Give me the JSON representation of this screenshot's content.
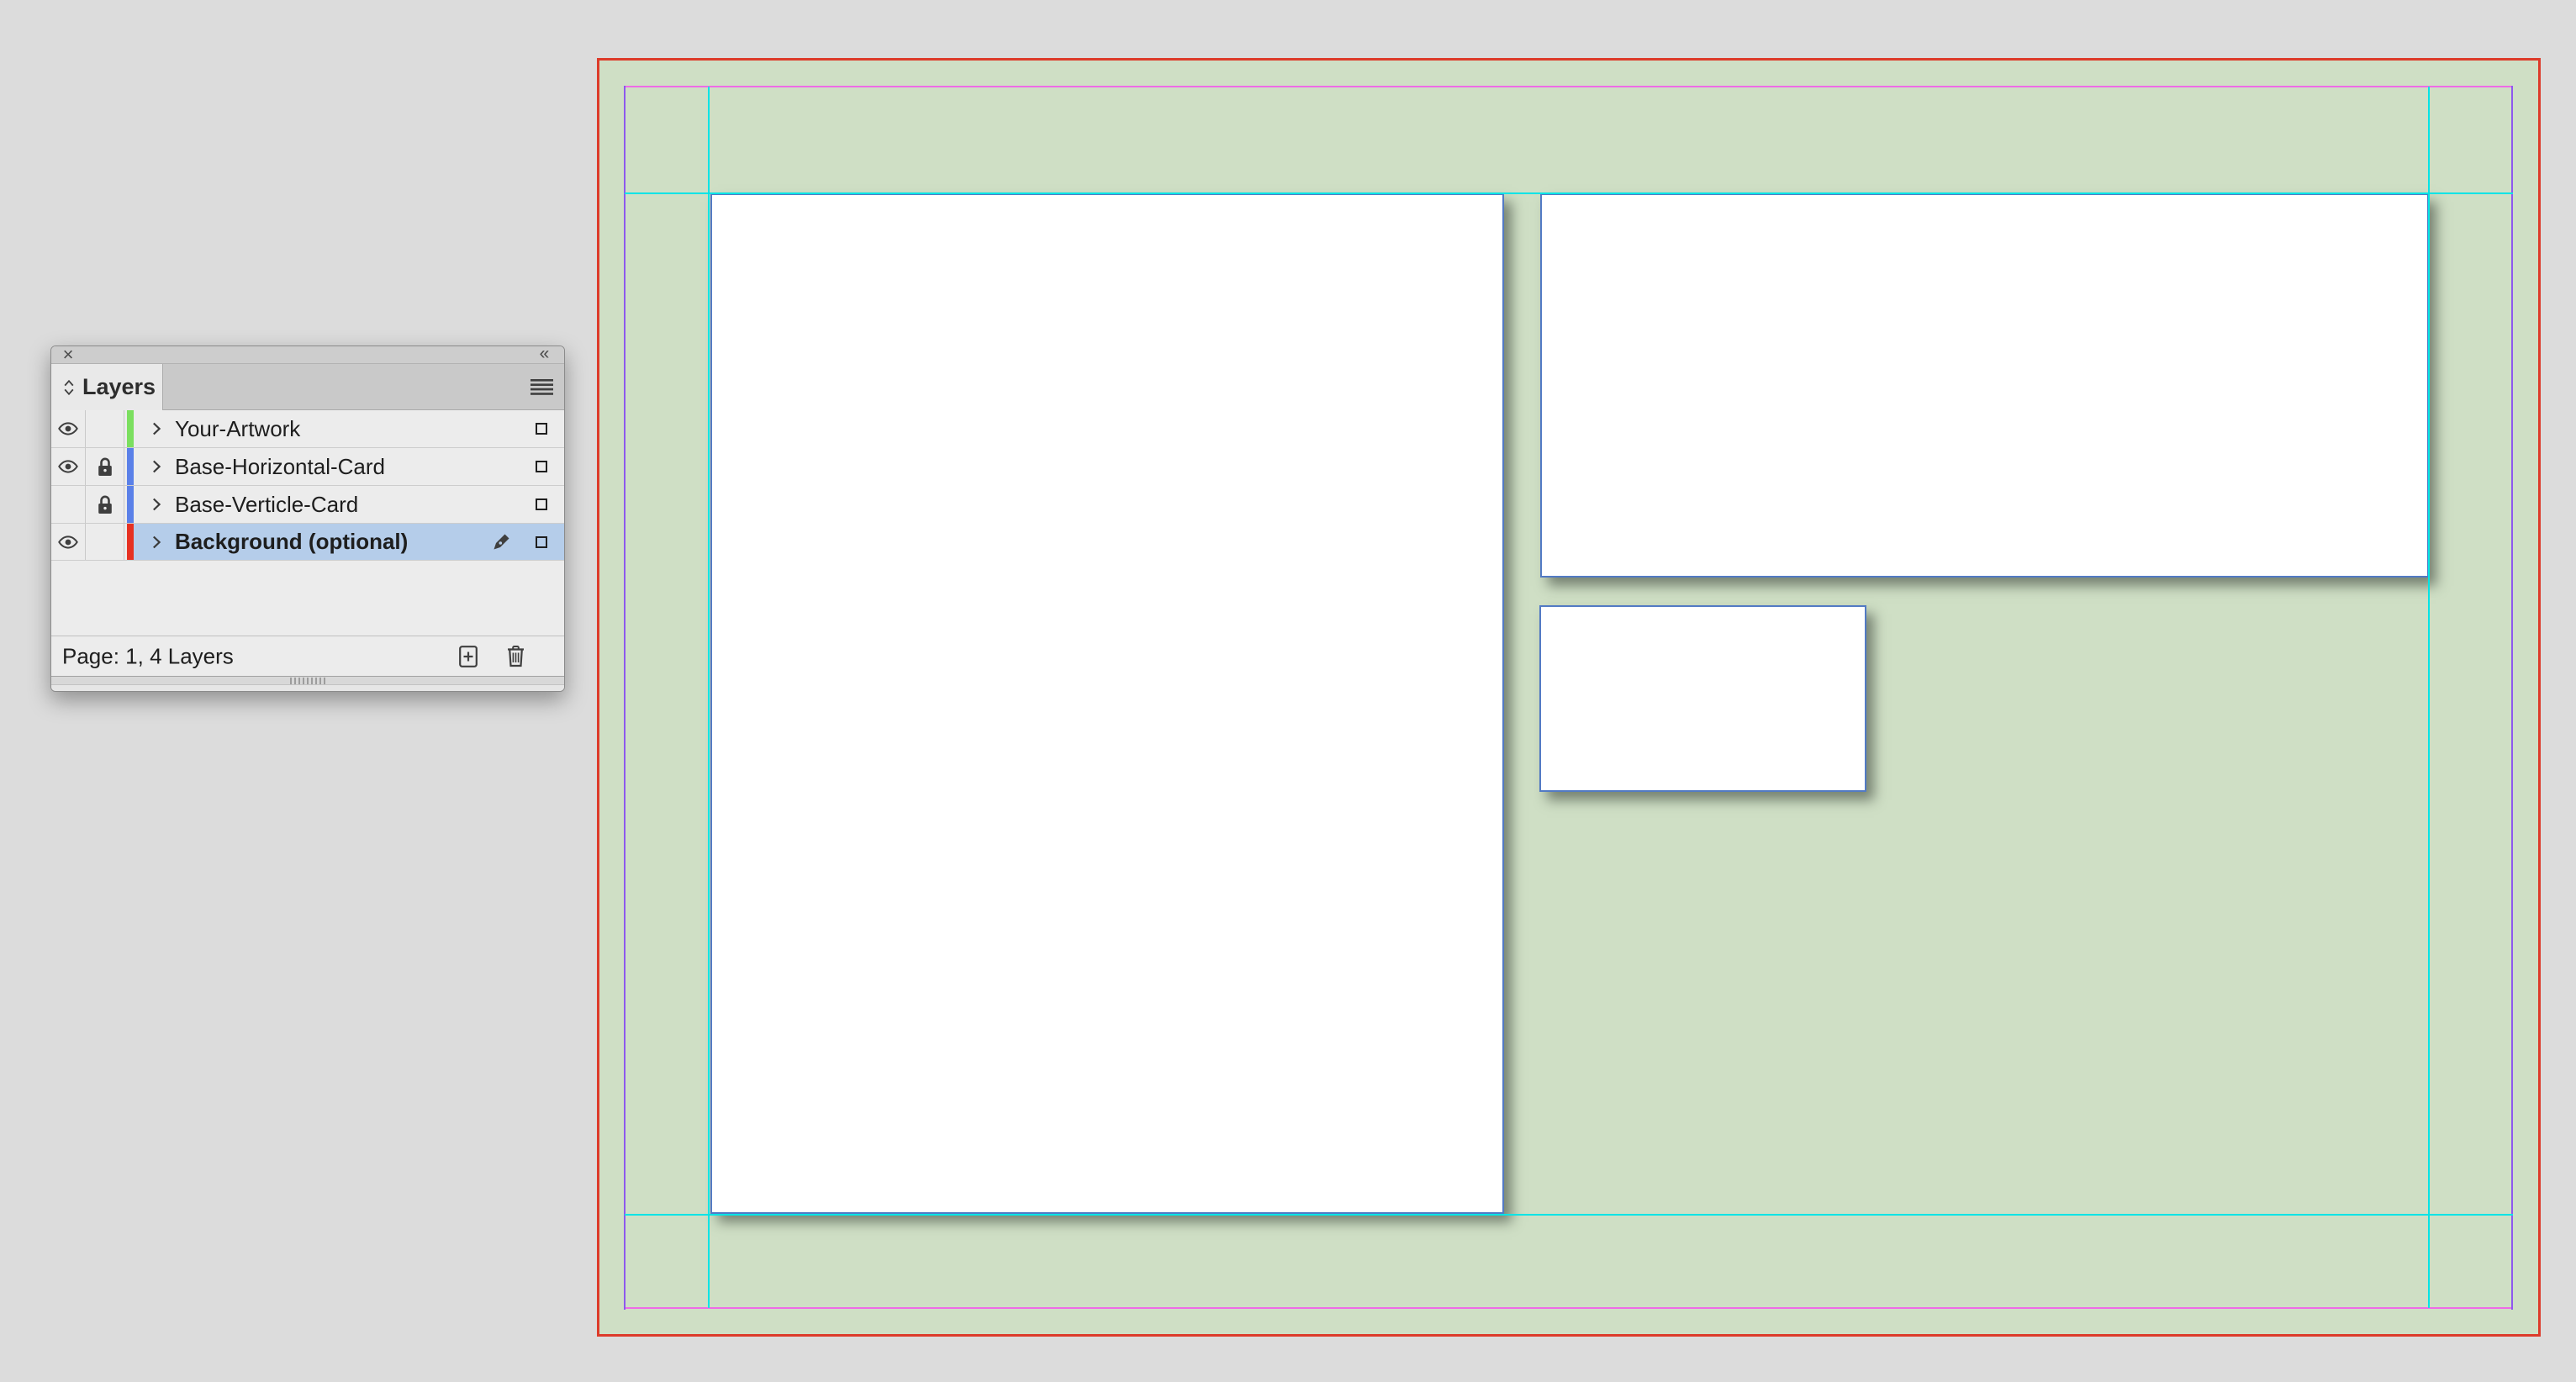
{
  "layers_panel": {
    "title": "Layers",
    "close_glyph": "×",
    "collapse_glyph": "«",
    "status_text": "Page: 1, 4 Layers",
    "selection_color": "#b5cdea",
    "panel_icons": [
      "close-icon",
      "collapse-panel-icon",
      "panel-cycle-icon",
      "panel-menu-icon",
      "eye-icon",
      "lock-icon",
      "disclosure-chevron-icon",
      "pen-nib-icon",
      "target-square",
      "new-layer-icon",
      "trash-icon",
      "resize-grip"
    ],
    "layers": [
      {
        "label": "Your-Artwork",
        "color": "#7bdf5f",
        "visible": true,
        "locked": false,
        "selected": false
      },
      {
        "label": "Base-Horizontal-Card",
        "color": "#5a80e8",
        "visible": true,
        "locked": true,
        "selected": false
      },
      {
        "label": "Base-Verticle-Card",
        "color": "#5a80e8",
        "visible": false,
        "locked": true,
        "selected": false
      },
      {
        "label": "Background (optional)",
        "color": "#e63122",
        "visible": true,
        "locked": false,
        "selected": true
      }
    ]
  },
  "canvas": {
    "pasteboard_color": "#dcdcdc",
    "page_color": "#cfdfc5",
    "bleed_edge_color": "#dd3b2a",
    "margin_guide_color": "#ee6ce6",
    "column_guide_color": "#8e58ee",
    "ruler_guide_color": "#00e4e6",
    "frame_edge_color": "#527ac4",
    "card_fill": "#ffffff"
  }
}
